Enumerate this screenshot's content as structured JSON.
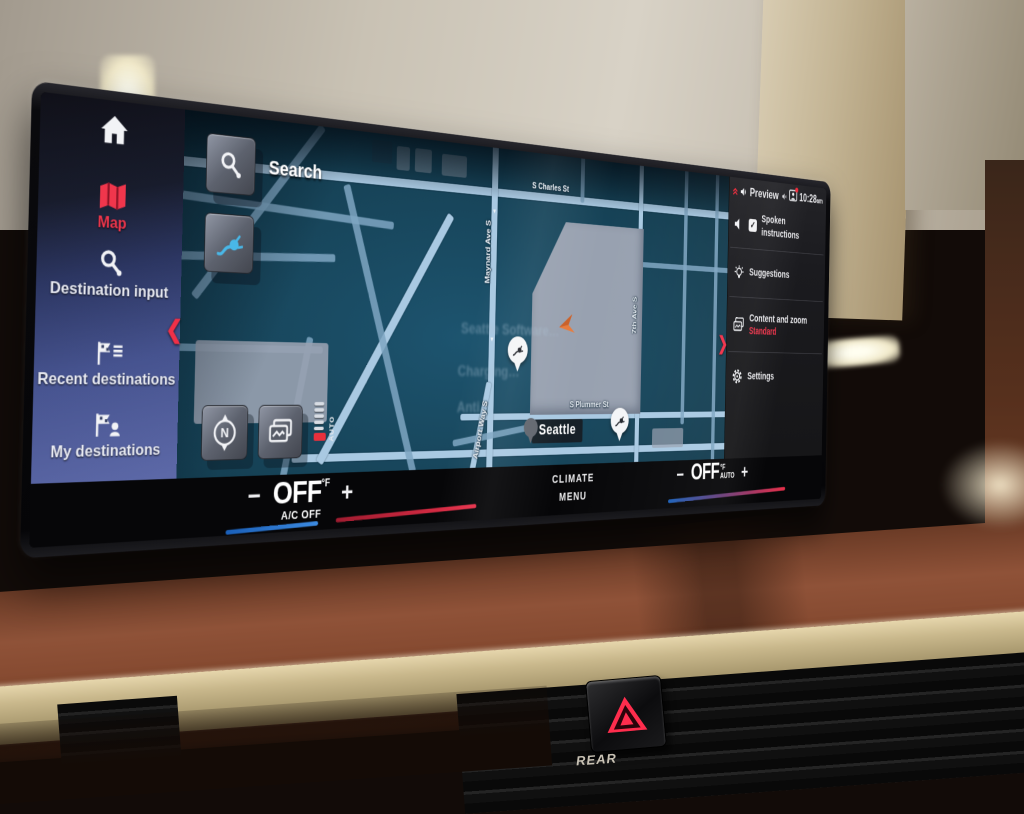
{
  "environment": {
    "rear_label": "REAR"
  },
  "sidebar": {
    "items": [
      {
        "id": "home",
        "label": ""
      },
      {
        "id": "map",
        "label": "Map",
        "active": true
      },
      {
        "id": "destination-input",
        "label": "Destination input"
      },
      {
        "id": "recent-destinations",
        "label": "Recent destinations"
      },
      {
        "id": "my-destinations",
        "label": "My destinations"
      }
    ]
  },
  "map": {
    "search_label": "Search",
    "city_label": "Seattle",
    "compass": "N",
    "zoom_mode": "AUTO",
    "streets": {
      "charles": "S Charles St",
      "maynard": "Maynard Ave S",
      "seventh": "7th Ave S",
      "plummer": "S Plummer St",
      "airport": "Airport Way S"
    },
    "ghost_labels": {
      "line1": "Seattle Software…",
      "line2": "Charging…",
      "line3": "Anti…"
    }
  },
  "status_bar": {
    "title": "Preview",
    "time": "10:28",
    "time_suffix": "am"
  },
  "settings_panel": {
    "spoken_instructions": "Spoken instructions",
    "suggestions": "Suggestions",
    "content_zoom": "Content and zoom",
    "content_zoom_value": "Standard",
    "settings": "Settings"
  },
  "climate": {
    "left": {
      "minus": "−",
      "value": "OFF",
      "unit": "°F",
      "plus": "+",
      "sub": "A/C OFF"
    },
    "center_line1": "CLIMATE",
    "center_line2": "MENU",
    "right": {
      "minus": "−",
      "value": "OFF",
      "unit": "°F",
      "mode": "AUTO",
      "plus": "+"
    }
  },
  "colors": {
    "accent_red": "#f0334a",
    "ev_blue": "#49b8e8",
    "map_bg": "#174459",
    "street": "#a9c9e2",
    "cool_bar": "#2b7fd6",
    "warm_bar": "#e03048"
  }
}
